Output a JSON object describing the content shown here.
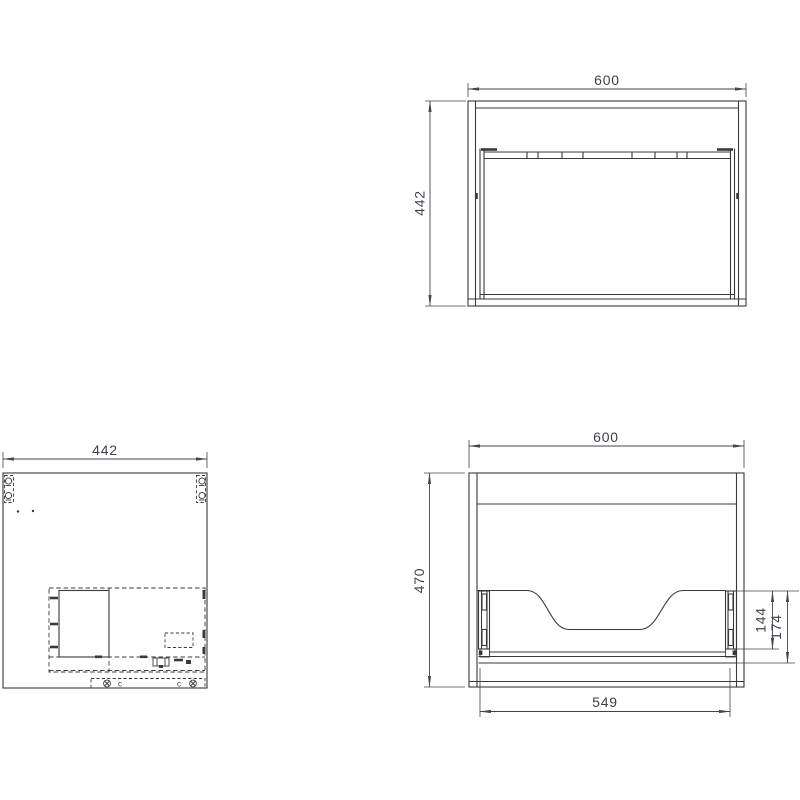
{
  "colors": {
    "line": "#3a3a3a",
    "dimension": "#45454e",
    "text": "#3f3f47",
    "background": "#ffffff"
  },
  "views": {
    "front": {
      "name": "front-view",
      "dim_width": "600",
      "dim_height": "442"
    },
    "plan": {
      "name": "plan-view",
      "dim_depth": "442",
      "fitting_mark_left": "c",
      "fitting_mark_right": "c"
    },
    "back": {
      "name": "back-view",
      "dim_width": "600",
      "dim_height": "470",
      "dim_bracket": "144",
      "dim_bracket_total": "174",
      "dim_rail_span": "549"
    }
  }
}
